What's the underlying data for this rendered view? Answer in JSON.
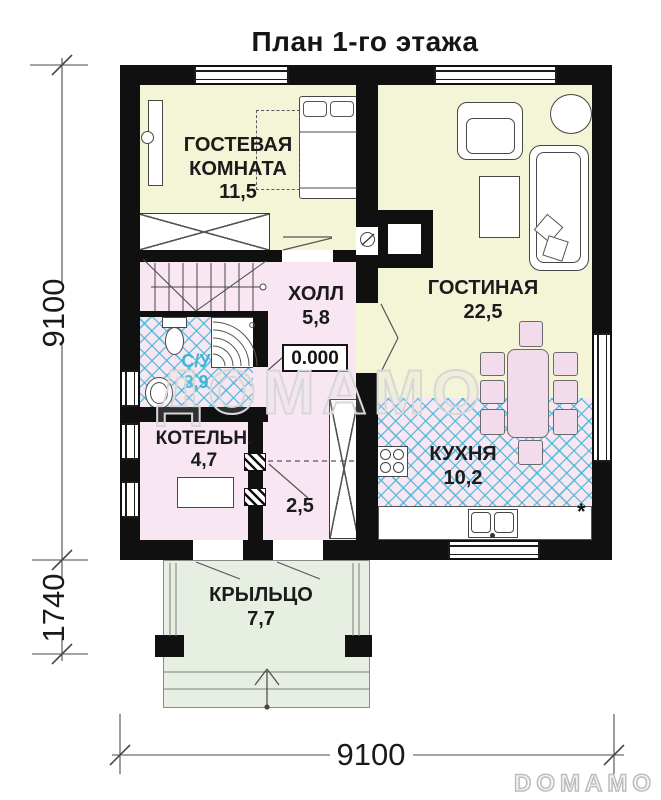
{
  "title": "План 1-го этажа",
  "rooms": {
    "guest": {
      "name": "ГОСТЕВАЯ КОМНАТА",
      "area": "11,5"
    },
    "living": {
      "name": "ГОСТИНАЯ",
      "area": "22,5"
    },
    "hall": {
      "name": "ХОЛЛ",
      "area": "5,8"
    },
    "bathroom": {
      "name": "С/У",
      "area": "3,9"
    },
    "boiler": {
      "name": "КОТЕЛЬН.",
      "area": "4,7"
    },
    "vestibule": {
      "area": "2,5"
    },
    "kitchen": {
      "name": "КУХНЯ",
      "area": "10,2"
    },
    "porch": {
      "name": "КРЫЛЬЦО",
      "area": "7,7"
    }
  },
  "elevation_mark": "0.000",
  "kitchen_note": "*",
  "dimensions": {
    "left_total": "9100",
    "left_porch": "1740",
    "bottom_total": "9100"
  },
  "watermark": "ДОМАМО",
  "logo": "DOMAMO",
  "colors": {
    "wall": "#101010",
    "room_cream": "#f4f4d7",
    "room_pink": "#f8e7f2",
    "tile_line_blue": "#43b7d8",
    "porch_green": "#e7efe3",
    "bath_label_blue": "#3db6d6"
  }
}
